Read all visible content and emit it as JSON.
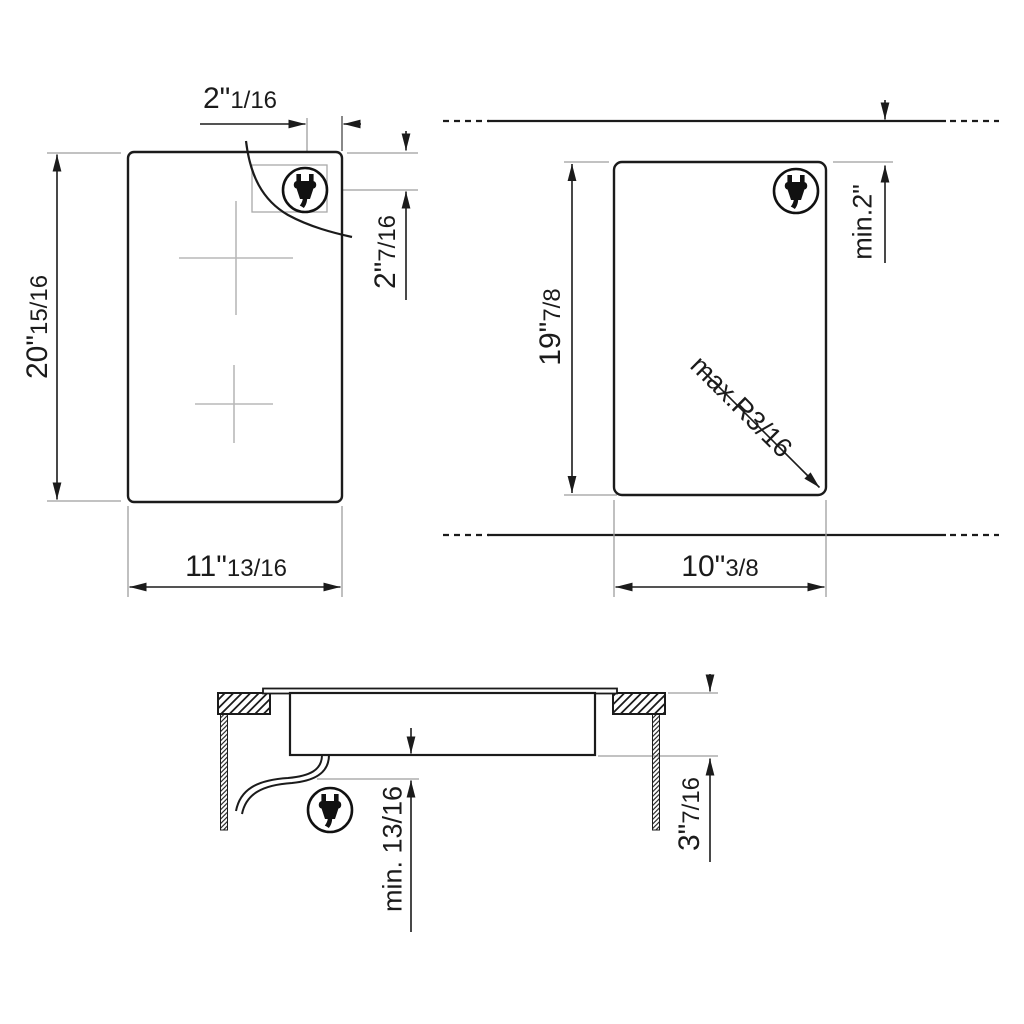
{
  "drawing": {
    "type": "appliance-installation-dimension-drawing",
    "ink_color": "#1b1b1b",
    "aux_line_color": "#9e9e9e",
    "mark_color": "#b9b9b9",
    "icons": {
      "plug": "power-plug-icon"
    },
    "top_view": {
      "height": {
        "main": "20\"",
        "frac": "15/16"
      },
      "width": {
        "main": "11\"",
        "frac": "13/16"
      },
      "plug_offset_horizontal": {
        "main": "2\"",
        "frac": "1/16"
      },
      "plug_offset_vertical": {
        "main": "2\"",
        "frac": "7/16"
      }
    },
    "cutout_view": {
      "height": {
        "main": "19\"",
        "frac": "7/8"
      },
      "width": {
        "main": "10\"",
        "frac": "3/8"
      },
      "rear_clearance": "min.2\"",
      "corner_radius": "max.R3/16"
    },
    "section_view": {
      "bottom_clearance": "min. 13/16",
      "recess_depth": {
        "main": "3\"",
        "frac": "7/16"
      }
    }
  }
}
